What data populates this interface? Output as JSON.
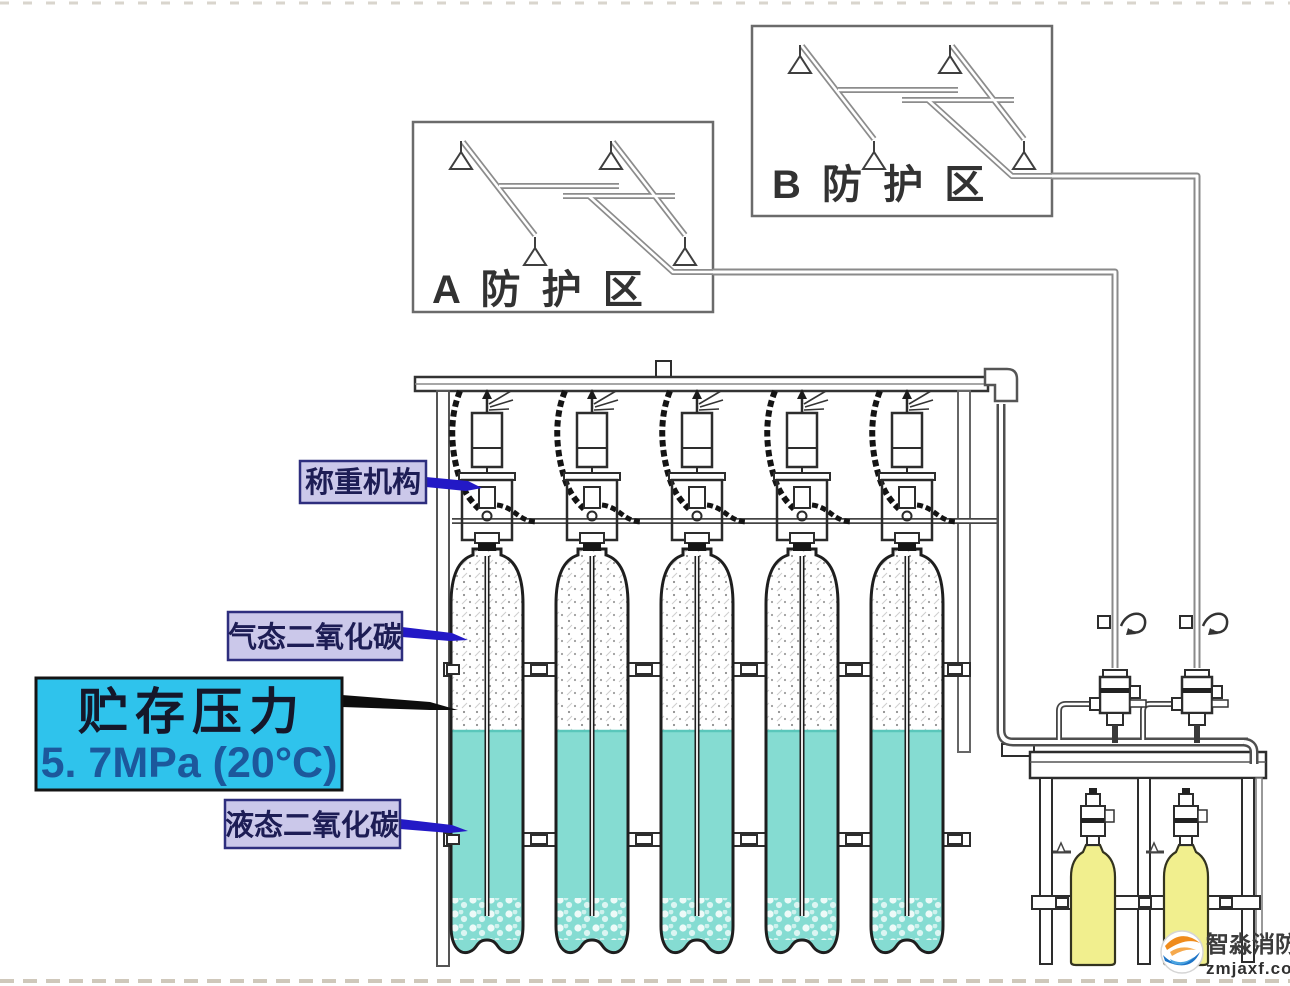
{
  "zones": {
    "a": {
      "label": "A 防 护 区"
    },
    "b": {
      "label": "B 防 护 区"
    }
  },
  "callouts": {
    "weighing": "称重机构",
    "gas": "气态二氧化碳",
    "pressure_line1": "贮存压力",
    "pressure_line2": "5. 7MPa (20°C)",
    "liquid": "液态二氧化碳"
  },
  "watermark": {
    "brand": "智淼消防",
    "site": "zmjaxf.com"
  },
  "colors": {
    "pressure_box_fill": "#2fc3ec",
    "callout_box_fill": "#cbc8ea",
    "callout_border": "#2e2e7e",
    "arrow_blue": "#2319c6",
    "arrow_black": "#0d0d0d",
    "liquid_teal": "#85dcd2",
    "pilot_yellow": "#f1ef8e",
    "line_dark": "#1e1e1e",
    "pipe_gray": "#8c8c8c"
  }
}
